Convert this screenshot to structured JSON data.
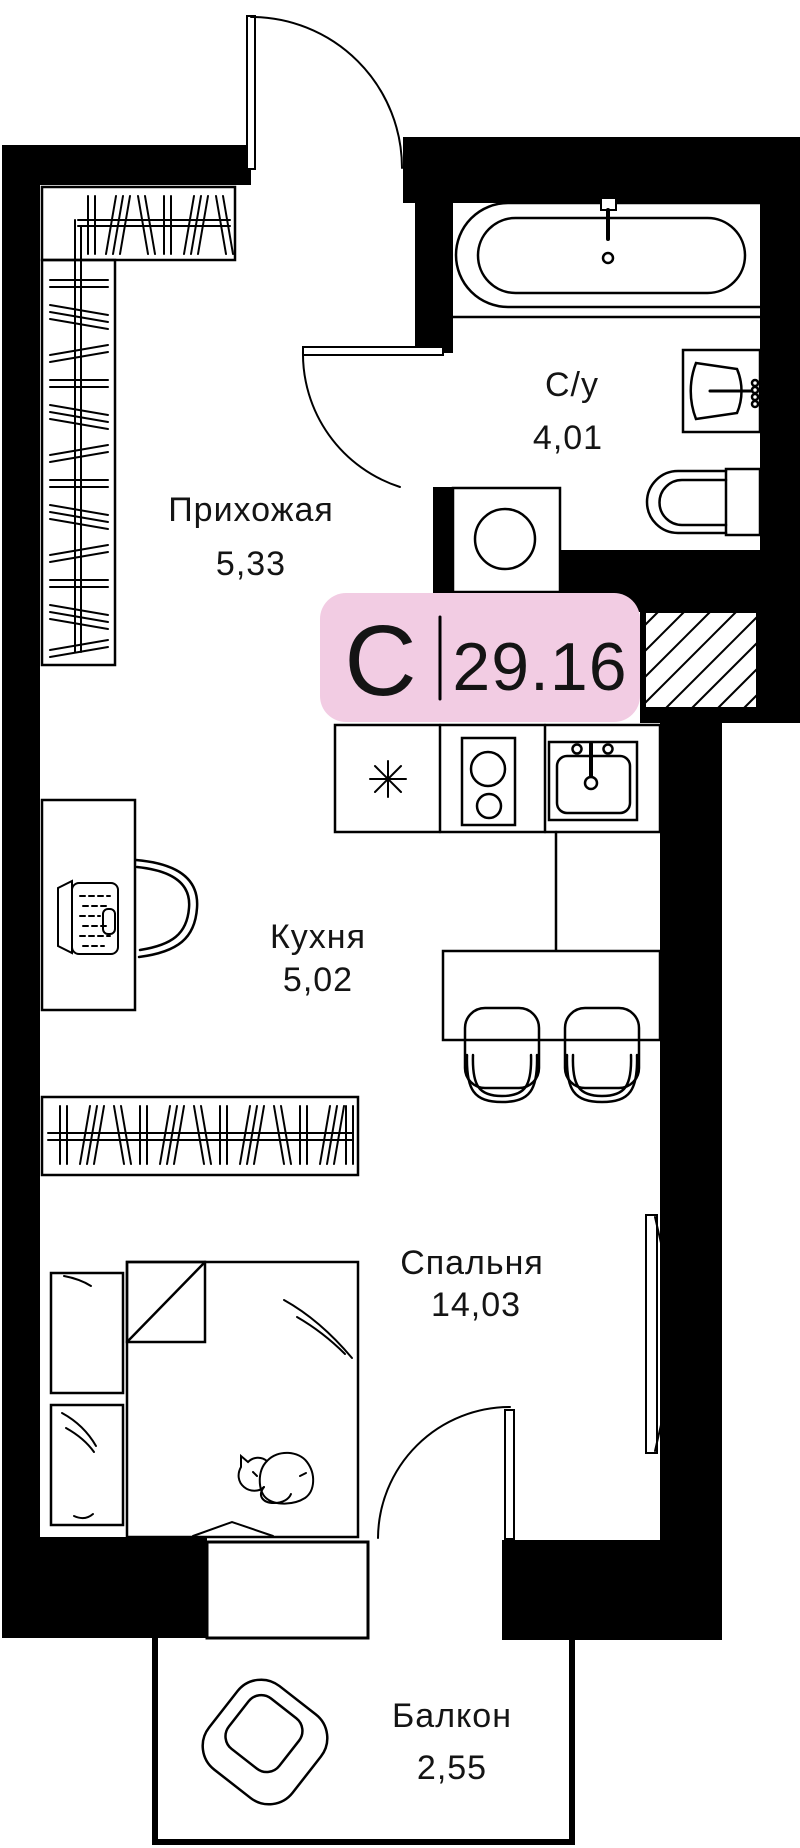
{
  "floor_plan": {
    "unit_badge": {
      "type_letter": "С",
      "area_value": "29.16"
    },
    "rooms": [
      {
        "name": "Прихожая",
        "area": "5,33"
      },
      {
        "name": "С/у",
        "area": "4,01"
      },
      {
        "name": "Кухня",
        "area": "5,02"
      },
      {
        "name": "Спальня",
        "area": "14,03"
      },
      {
        "name": "Балкон",
        "area": "2,55"
      }
    ],
    "colors": {
      "badge_background": "#F2CCE3",
      "walls": "#000000",
      "lines": "#000000",
      "background": "#FFFFFF"
    },
    "furniture_icons": [
      "bathtub-icon",
      "washbasin-icon",
      "toilet-icon",
      "washing-machine-icon",
      "ventilation-shaft-hatch",
      "fridge-asterisk-icon",
      "hob-icon",
      "kitchen-sink-icon",
      "dining-table-icon",
      "chair-icon",
      "desk-icon",
      "laptop-icon",
      "desk-chair-icon",
      "wardrobe-icon",
      "bed-icon",
      "nightstand-icon",
      "cat-icon",
      "window-icon",
      "armchair-icon",
      "door-swing-icon"
    ]
  }
}
